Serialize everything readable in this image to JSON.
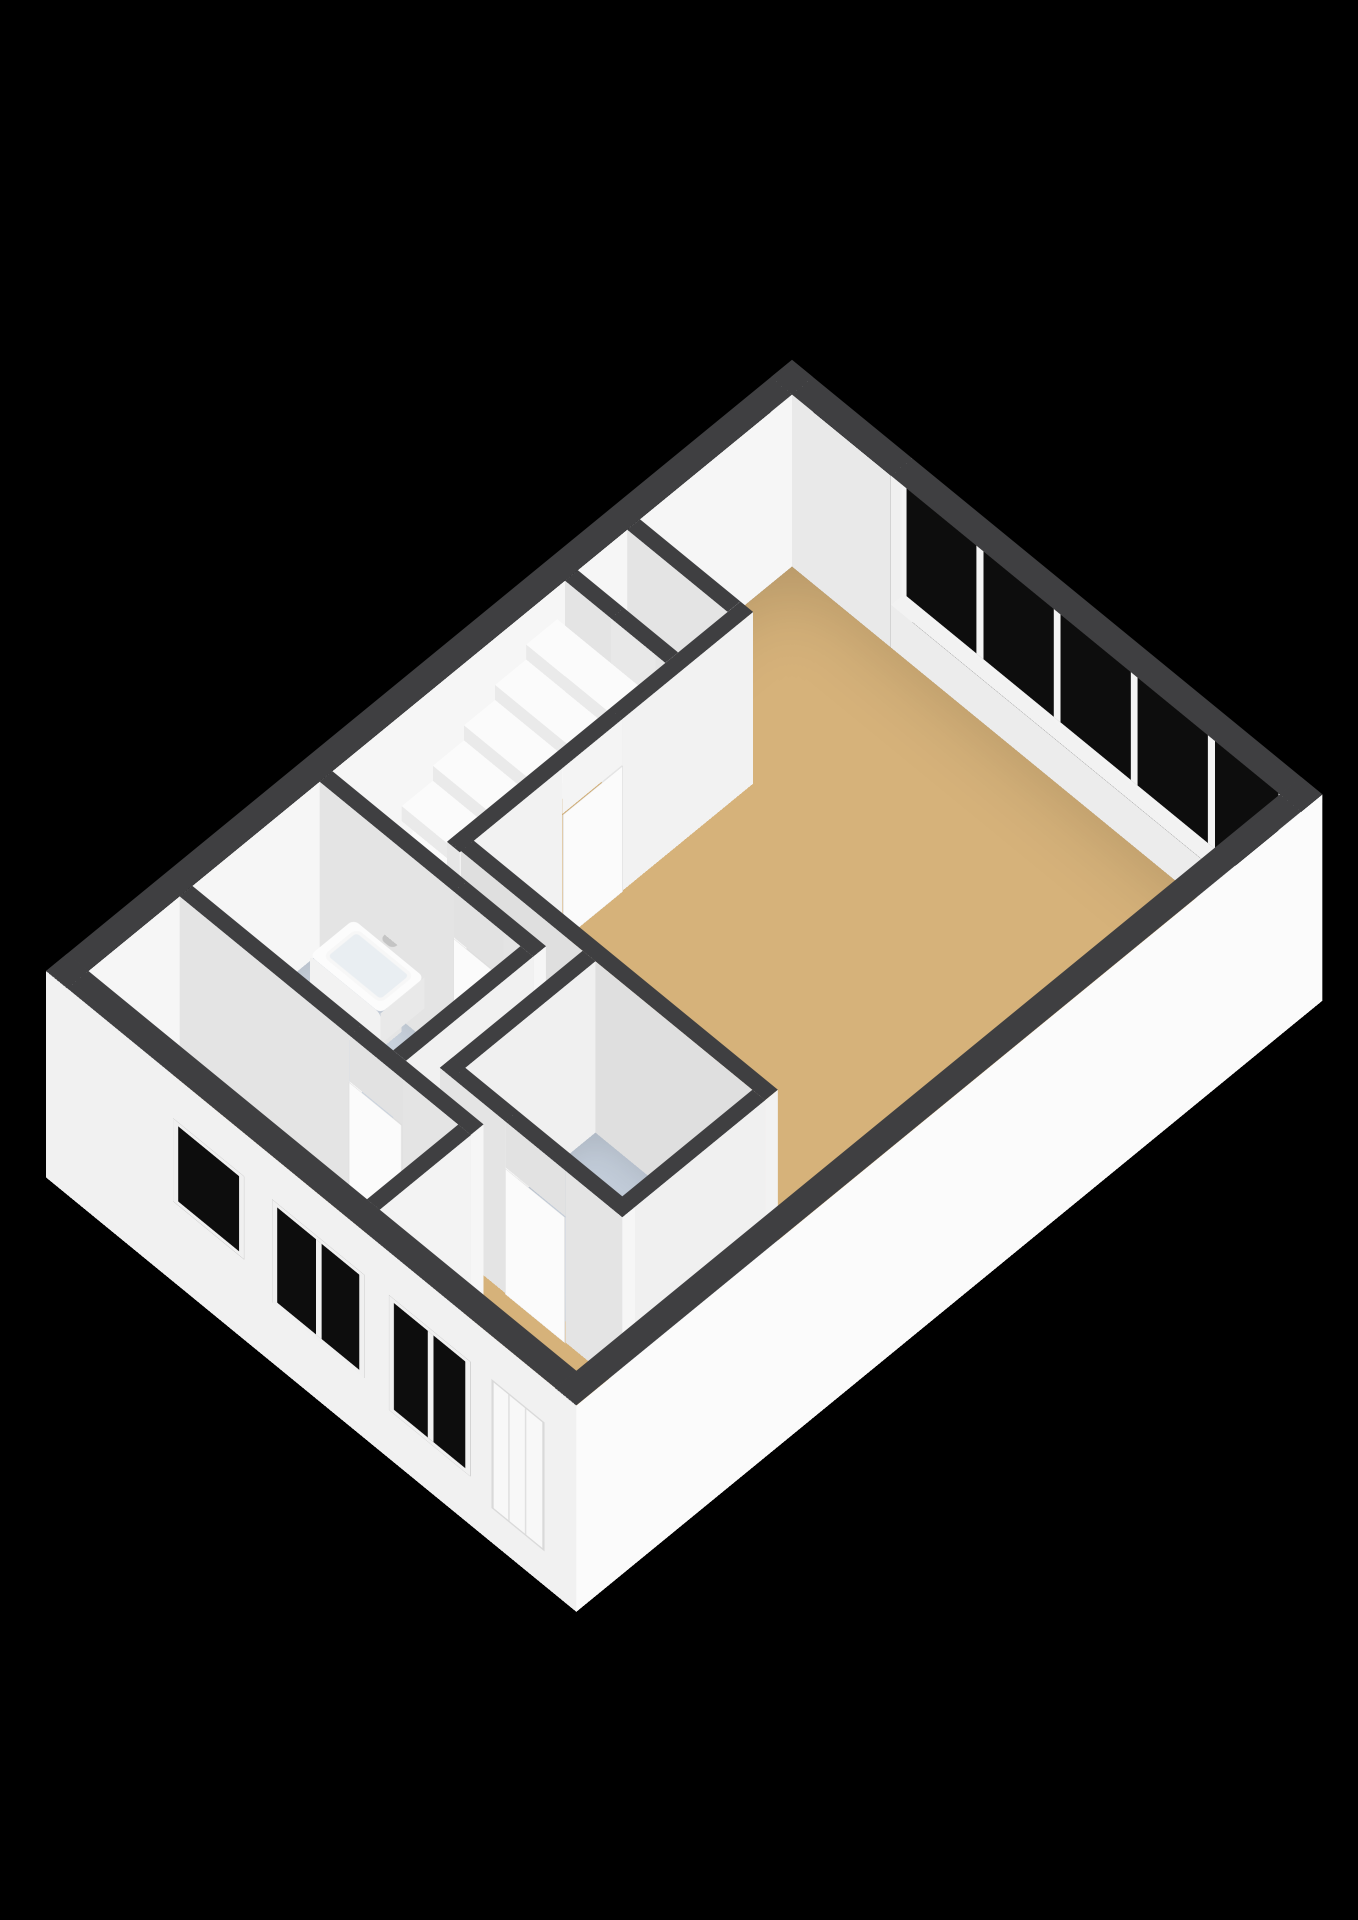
{
  "colors": {
    "background": "#000000",
    "wall_cap": "#3f3f41",
    "wall_east_face": "#f6f6f6",
    "wall_south_face": "#e4e4e4",
    "window_wall_face": "#e9e9e9",
    "exterior_right_face": "#fbfbfb",
    "exterior_facade_face": "#f1f1f1",
    "floor_wood": "#d6b27a",
    "floor_bath": "#cad3de",
    "floor_toilet": "#c2ccd9",
    "glass": "#0d0d0d",
    "frame": "#f0f0f0",
    "step_top": "#fbfbfb",
    "step_riser_s": "#eaeaea",
    "step_riser_e": "#f1f1f1",
    "stair_void": "#0a0a0a"
  },
  "camera": {
    "x": 792,
    "y": 532,
    "tilt_deg": 35,
    "turn_deg": 45
  },
  "plan": {
    "width": 750,
    "depth": 1055,
    "wall_height": 300,
    "exterior_thickness": 30,
    "interior_thickness": 18
  },
  "rooms": [
    {
      "name": "living-room-and-hall-floor",
      "x1": 30,
      "y1": 30,
      "x2": 720,
      "y2": 1025,
      "color": "#d6b27a",
      "z": 0.5,
      "cls": "floorbase"
    },
    {
      "name": "bathroom-floor",
      "x1": 30,
      "y1": 698,
      "x2": 314,
      "y2": 878,
      "color": "#cad3de",
      "z": 1.2,
      "cls": "floorwet"
    },
    {
      "name": "toilet-floor",
      "x1": 380,
      "y1": 658,
      "x2": 602,
      "y2": 842,
      "color": "#c2ccd9",
      "z": 1.2,
      "cls": "floorwet"
    }
  ],
  "caps": [
    {
      "name": "cap-exterior-north",
      "x1": 0,
      "y1": 0,
      "x2": 750,
      "y2": 30
    },
    {
      "name": "cap-exterior-west",
      "x1": 0,
      "y1": 0,
      "x2": 30,
      "y2": 1055
    },
    {
      "name": "cap-exterior-south",
      "x1": 0,
      "y1": 1025,
      "x2": 750,
      "y2": 1055
    },
    {
      "name": "cap-exterior-east",
      "x1": 720,
      "y1": 0,
      "x2": 750,
      "y2": 1055
    },
    {
      "name": "cap-wall-v1",
      "x1": 172,
      "y1": 245,
      "x2": 190,
      "y2": 660
    },
    {
      "name": "cap-closet-north",
      "x1": 30,
      "y1": 245,
      "x2": 172,
      "y2": 263
    },
    {
      "name": "cap-closet-south",
      "x1": 30,
      "y1": 333,
      "x2": 172,
      "y2": 351
    },
    {
      "name": "cap-living-south",
      "x1": 172,
      "y1": 640,
      "x2": 620,
      "y2": 658
    },
    {
      "name": "cap-toilet-west",
      "x1": 362,
      "y1": 658,
      "x2": 380,
      "y2": 860
    },
    {
      "name": "cap-toilet-east",
      "x1": 602,
      "y1": 658,
      "x2": 620,
      "y2": 860
    },
    {
      "name": "cap-toilet-south",
      "x1": 362,
      "y1": 842,
      "x2": 620,
      "y2": 860
    },
    {
      "name": "cap-bath-north",
      "x1": 30,
      "y1": 680,
      "x2": 332,
      "y2": 698
    },
    {
      "name": "cap-bath-east",
      "x1": 314,
      "y1": 698,
      "x2": 332,
      "y2": 878
    },
    {
      "name": "cap-bedroom-north",
      "x1": 30,
      "y1": 878,
      "x2": 442,
      "y2": 896
    },
    {
      "name": "cap-bedroom-east",
      "x1": 424,
      "y1": 896,
      "x2": 442,
      "y2": 1025
    }
  ],
  "walls": [
    {
      "name": "wall-v1-upper",
      "x1": 172,
      "y1": 245,
      "x2": 190,
      "y2": 430,
      "s": "#e6e6e6",
      "e": "#f2f2f2"
    },
    {
      "name": "wall-v1-lower",
      "x1": 172,
      "y1": 515,
      "x2": 190,
      "y2": 660,
      "s": "#e6e6e6",
      "e": "#f2f2f2"
    },
    {
      "name": "wall-closet-north",
      "x1": 30,
      "y1": 245,
      "x2": 172,
      "y2": 263
    },
    {
      "name": "wall-closet-south-a",
      "x1": 30,
      "y1": 333,
      "x2": 95,
      "y2": 351
    },
    {
      "name": "wall-closet-south-b",
      "x1": 158,
      "y1": 333,
      "x2": 172,
      "y2": 351
    },
    {
      "name": "wall-living-south",
      "x1": 172,
      "y1": 640,
      "x2": 620,
      "y2": 658,
      "s": "#dfdfdf",
      "e": "#f2f2f2"
    },
    {
      "name": "wall-toilet-west",
      "x1": 362,
      "y1": 658,
      "x2": 380,
      "y2": 860,
      "s": "#dcdcdc",
      "e": "#f0f0f0"
    },
    {
      "name": "wall-toilet-east",
      "x1": 602,
      "y1": 658,
      "x2": 620,
      "y2": 860,
      "s": "#dcdcdc",
      "e": "#f0f0f0"
    },
    {
      "name": "wall-toilet-south-a",
      "x1": 362,
      "y1": 842,
      "x2": 455,
      "y2": 860
    },
    {
      "name": "wall-toilet-south-b",
      "x1": 540,
      "y1": 842,
      "x2": 620,
      "y2": 860
    },
    {
      "name": "wall-bath-north-a",
      "x1": 30,
      "y1": 680,
      "x2": 220,
      "y2": 698
    },
    {
      "name": "wall-bath-north-b",
      "x1": 290,
      "y1": 680,
      "x2": 332,
      "y2": 698
    },
    {
      "name": "wall-bath-east",
      "x1": 314,
      "y1": 698,
      "x2": 332,
      "y2": 878,
      "s": "#dedede",
      "e": "#f1f1f1"
    },
    {
      "name": "wall-bedroom-north-a",
      "x1": 30,
      "y1": 878,
      "x2": 270,
      "y2": 896
    },
    {
      "name": "wall-bedroom-north-b",
      "x1": 345,
      "y1": 878,
      "x2": 442,
      "y2": 896
    },
    {
      "name": "wall-bedroom-east",
      "x1": 424,
      "y1": 896,
      "x2": 442,
      "y2": 1025,
      "s": "#e2e2e2",
      "e": "#f3f3f3"
    }
  ],
  "planes": [
    {
      "name": "wall-exterior-west-inner-face",
      "type": "e",
      "x": 30,
      "y": 0,
      "w": 300,
      "h": 1055,
      "z": 0,
      "color": "#f6f6f6"
    },
    {
      "name": "window-wall-segment-left-face",
      "type": "s",
      "x": 0,
      "y": 30,
      "w": 170,
      "h": 300,
      "z": 0,
      "color": "#e9e9e9"
    },
    {
      "name": "window-wall-left-jamb",
      "type": "e",
      "x": 170,
      "y": 0,
      "w": 300,
      "h": 30,
      "z": 0,
      "color": "#f0f0f0"
    },
    {
      "name": "window-wall-segment-right-face",
      "type": "s",
      "x": 718,
      "y": 30,
      "w": 32,
      "h": 300,
      "z": 0,
      "color": "#e9e9e9"
    },
    {
      "name": "window-sill-top",
      "type": "top",
      "x": 170,
      "y": 0,
      "w": 548,
      "h": 30,
      "z": 75,
      "color": "#f2f2f2"
    },
    {
      "name": "window-sill-face",
      "type": "s",
      "x": 170,
      "y": 30,
      "w": 548,
      "h": 75,
      "z": 0,
      "color": "#ececec"
    },
    {
      "name": "window-band-glazing",
      "type": "s",
      "x": 170,
      "y": 15,
      "w": 548,
      "h": 220,
      "z": 75,
      "color": "#0d0d0d",
      "cls": "band",
      "style": {
        "backgroundImage": "repeating-linear-gradient(90deg, #0d0d0d 0px, #0d0d0d 99px, #f3f3f3 99px, #f3f3f3 109px)"
      }
    },
    {
      "name": "facade-south-outer-face",
      "type": "s",
      "x": 0,
      "y": 1055,
      "w": 750,
      "h": 360,
      "z": -60,
      "color": "#f1f1f1",
      "facade": true
    },
    {
      "name": "wall-exterior-east-outer-face",
      "type": "e",
      "x": 750,
      "y": 0,
      "w": 360,
      "h": 1055,
      "z": -60,
      "color": "#fbfbfb"
    },
    {
      "name": "lintel-living-door",
      "type": "e",
      "x": 190,
      "y": 430,
      "w": 80,
      "h": 85,
      "z": 220,
      "color": "#f4f4f4"
    },
    {
      "name": "lintel-closet-opening",
      "type": "s",
      "x": 95,
      "y": 351,
      "w": 63,
      "h": 80,
      "z": 220,
      "color": "#e8e8e8"
    },
    {
      "name": "lintel-toilet-door",
      "type": "s",
      "x": 455,
      "y": 860,
      "w": 85,
      "h": 80,
      "z": 220,
      "color": "#e2e2e2"
    },
    {
      "name": "lintel-bathroom-door",
      "type": "s",
      "x": 220,
      "y": 698,
      "w": 70,
      "h": 80,
      "z": 220,
      "color": "#e2e2e2"
    },
    {
      "name": "lintel-bedroom-door",
      "type": "s",
      "x": 270,
      "y": 896,
      "w": 75,
      "h": 80,
      "z": 220,
      "color": "#e2e2e2"
    },
    {
      "name": "door-living-room",
      "type": "e",
      "x": 191,
      "y": 430,
      "w": 220,
      "h": 85,
      "z": 0,
      "color": "#fbfbfb",
      "cls": "door-e"
    },
    {
      "name": "door-bathroom",
      "type": "s",
      "x": 220,
      "y": 699,
      "w": 70,
      "h": 220,
      "z": 0,
      "color": "#fbfbfb",
      "cls": "door-s"
    },
    {
      "name": "door-toilet",
      "type": "s",
      "x": 455,
      "y": 861,
      "w": 85,
      "h": 220,
      "z": 0,
      "color": "#fbfbfb",
      "cls": "door-s"
    },
    {
      "name": "door-bedroom",
      "type": "s",
      "x": 270,
      "y": 897,
      "w": 75,
      "h": 220,
      "z": 0,
      "color": "#fbfbfb",
      "cls": "door-s"
    },
    {
      "name": "sink-top",
      "type": "top",
      "x": 80,
      "y": 700,
      "w": 100,
      "h": 62,
      "z": 112,
      "color": "#fcfcfc",
      "cls": "rounded"
    },
    {
      "name": "sink-basin",
      "type": "top",
      "x": 90,
      "y": 706,
      "w": 82,
      "h": 48,
      "z": 113,
      "color": "#e9eef2",
      "cls": "basin"
    },
    {
      "name": "sink-front-face",
      "type": "s",
      "x": 80,
      "y": 762,
      "w": 100,
      "h": 54,
      "z": 58,
      "color": "#f2f2f2",
      "cls": "rounded"
    },
    {
      "name": "sink-side-face",
      "type": "e",
      "x": 180,
      "y": 700,
      "w": 54,
      "h": 62,
      "z": 58,
      "color": "#e9e9e9"
    },
    {
      "name": "sink-pedestal-front",
      "type": "s",
      "x": 104,
      "y": 752,
      "w": 52,
      "h": 58,
      "z": 0,
      "color": "#ededed"
    },
    {
      "name": "sink-pedestal-side",
      "type": "e",
      "x": 156,
      "y": 708,
      "w": 58,
      "h": 44,
      "z": 0,
      "color": "#e5e5e5"
    },
    {
      "name": "sink-faucet",
      "type": "top",
      "x": 122,
      "y": 692,
      "w": 18,
      "h": 13,
      "z": 126,
      "color": "#c4c4c4",
      "cls": "rounded"
    }
  ],
  "facade_items": [
    {
      "name": "front-door",
      "cls": "fdoor",
      "left": 630,
      "top": 60,
      "w": 75,
      "h": 225
    },
    {
      "name": "facade-window-tall",
      "cls": "fglass",
      "left": 485,
      "top": 85,
      "w": 115,
      "h": 200,
      "style": {
        "backgroundImage": "linear-gradient(90deg, transparent 0 48px, #f0f0f0 48px 56px, transparent 56px)"
      }
    },
    {
      "name": "facade-window-wide",
      "cls": "fglass",
      "left": 320,
      "top": 105,
      "w": 130,
      "h": 180,
      "style": {
        "backgroundImage": "linear-gradient(90deg, transparent 0 55px, #f0f0f0 55px 63px, transparent 63px)"
      }
    },
    {
      "name": "facade-window-small",
      "cls": "fglass",
      "left": 180,
      "top": 140,
      "w": 100,
      "h": 145
    }
  ],
  "stairs": {
    "step_depth": 44,
    "riser_height": 26,
    "steps": [
      {
        "x": 54,
        "y": 538,
        "w": 96,
        "rot": -90,
        "z": 38
      },
      {
        "x": 54,
        "y": 538,
        "w": 96,
        "rot": -68,
        "z": 62
      },
      {
        "x": 54,
        "y": 538,
        "w": 96,
        "rot": -45,
        "z": 88
      },
      {
        "x": 54,
        "y": 538,
        "w": 96,
        "rot": -22,
        "z": 114
      },
      {
        "x": 30,
        "y": 538,
        "w": 120,
        "rot": 0,
        "z": 140
      },
      {
        "x": 30,
        "y": 494,
        "w": 120,
        "rot": 0,
        "z": 166
      },
      {
        "x": 30,
        "y": 450,
        "w": 120,
        "rot": 0,
        "z": 192
      },
      {
        "x": 30,
        "y": 406,
        "w": 120,
        "rot": 0,
        "z": 218
      },
      {
        "x": 30,
        "y": 362,
        "w": 120,
        "rot": 0,
        "z": 244
      }
    ],
    "void": {
      "x": 36,
      "y": 470,
      "w": 86,
      "h": 178,
      "clip": "polygon(0 4%, 100% 0, 100% 62%, 0 100%)"
    }
  }
}
